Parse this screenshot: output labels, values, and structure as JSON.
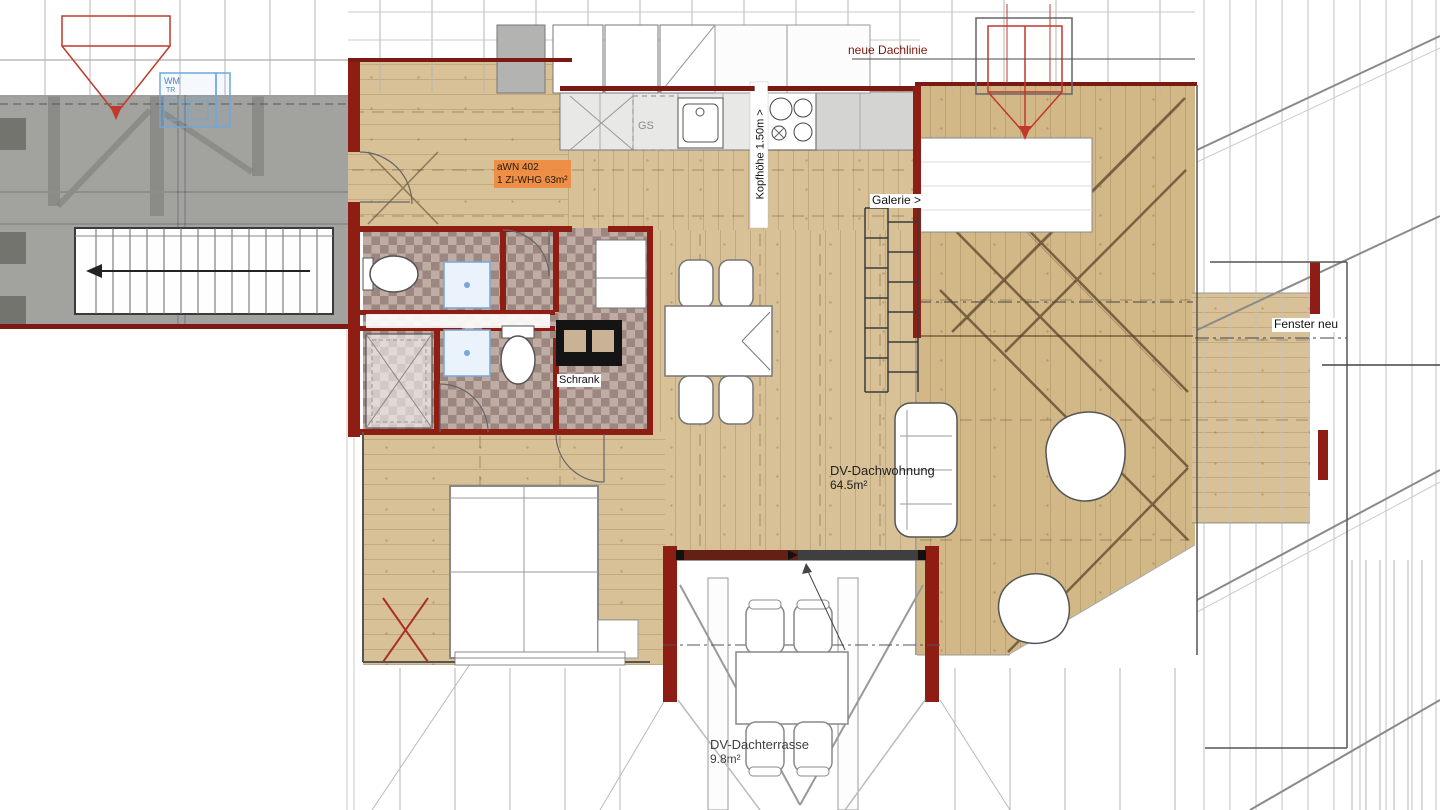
{
  "labels": {
    "neue_dachlinie": "neue Dachlinie",
    "unit_line1": "aWN 402",
    "unit_line2": "1 ZI-WHG 63m²",
    "kopfhoehe": "Kopfhöhe 1.50m >",
    "galerie": "Galerie >",
    "fenster_neu": "Fenster neu",
    "schrank": "Schrank",
    "wohnung_name": "DV-Dachwohnung",
    "wohnung_area": "64.5m²",
    "terrasse_name": "DV-Dachterrasse",
    "terrasse_area": "9.8m²",
    "gs": "GS",
    "wm": "WM",
    "tr": "TR"
  },
  "colors": {
    "wood_floor": "#d8c197",
    "existing_gray": "#a2a29e",
    "wall_red": "#8e1d14",
    "dark_wall_red": "#7a1a12",
    "label_orange": "#f08a3e",
    "new_roofline_red": "#c0392b",
    "tile_light": "#bfaca3",
    "tile_dark": "#9c8680",
    "counter_gray": "#e8e8e6",
    "fixture_blue": "#7aa6d8",
    "text_blue": "#4a7fc1"
  }
}
